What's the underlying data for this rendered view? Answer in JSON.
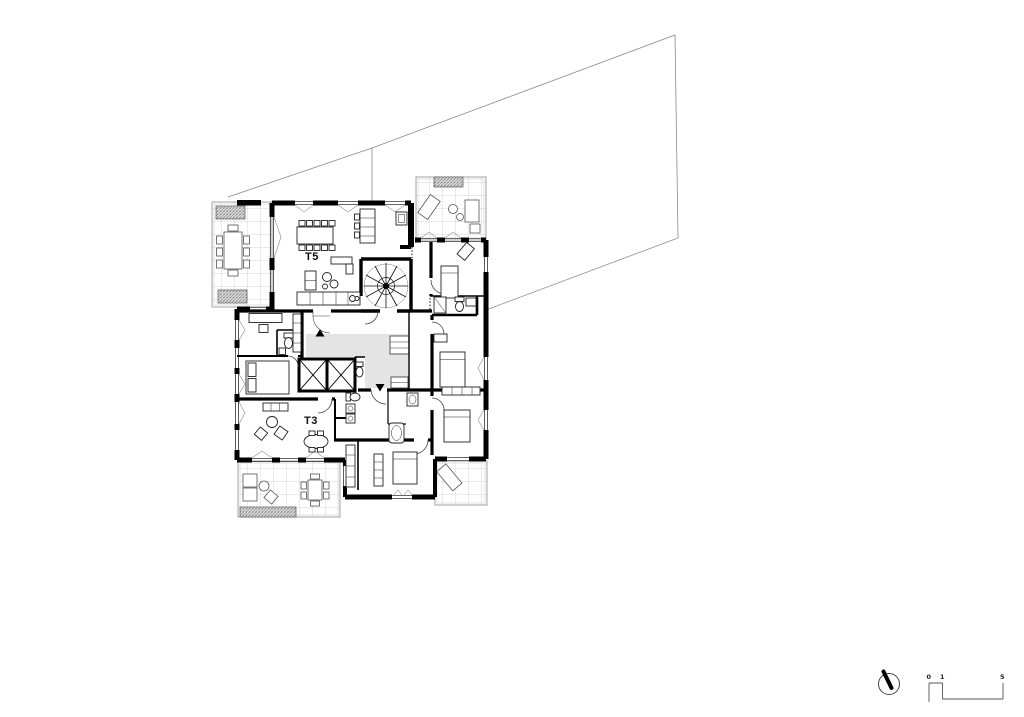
{
  "plan": {
    "type": "architectural-floor-plan",
    "units": [
      {
        "id": "t5",
        "label": "T5"
      },
      {
        "id": "t3",
        "label": "T3"
      }
    ]
  },
  "scale_bar": {
    "ticks": [
      "0",
      "1",
      "5"
    ]
  },
  "icons": {
    "north_indicator": "north-arrow"
  },
  "colors": {
    "walls": "#000000",
    "hall_fill": "#e4e4e4",
    "terrace_grid": "#c6c6c6",
    "property_line": "#8a8a8a",
    "background": "#ffffff"
  }
}
